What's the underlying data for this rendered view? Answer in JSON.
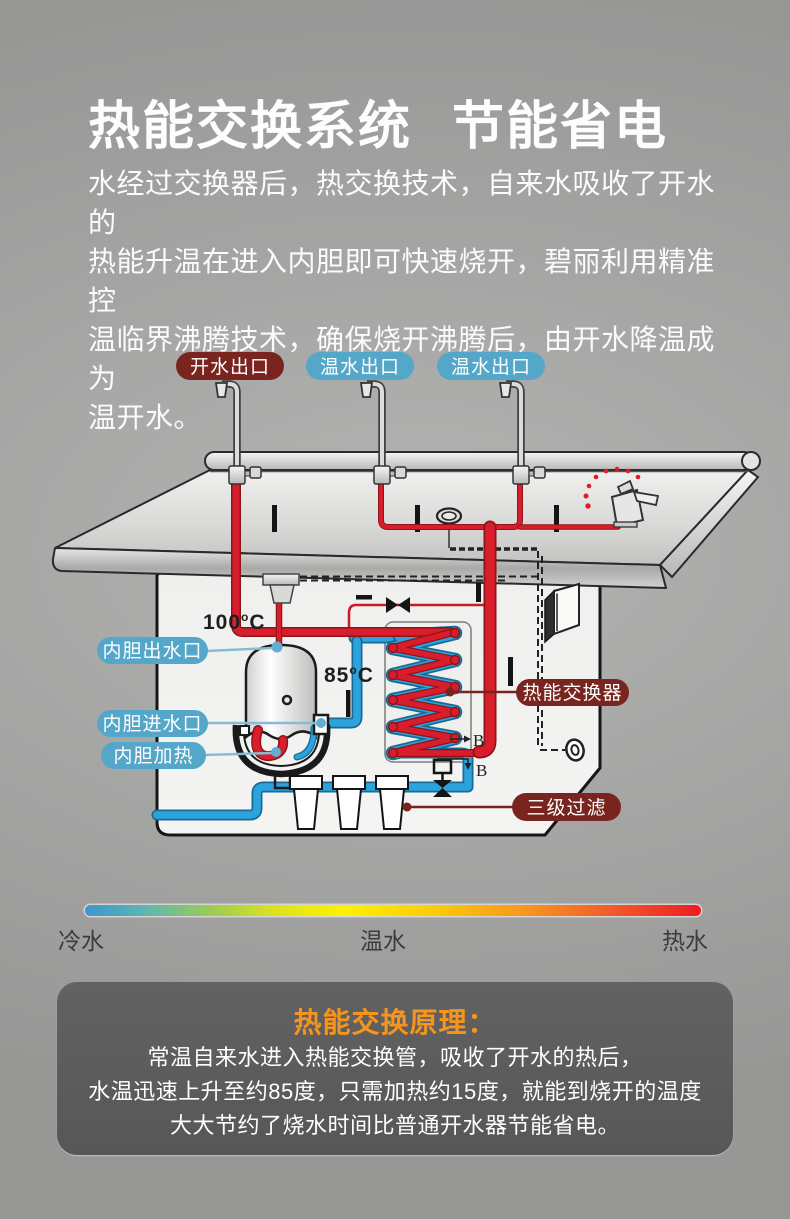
{
  "header": {
    "title_part1": "热能交换系统",
    "title_part2": "节能省电"
  },
  "intro": {
    "lines": [
      "水经过交换器后，热交换技术，自来水吸收了开水的",
      "热能升温在进入内胆即可快速烧开，碧丽利用精准控",
      "温临界沸腾技术，确保烧开沸腾后，由开水降温成为",
      "温开水。"
    ]
  },
  "diagram": {
    "outlet_labels": [
      {
        "text": "开水出口",
        "color": "#7a2420"
      },
      {
        "text": "温水出口",
        "color": "#55a7c9"
      },
      {
        "text": "温水出口",
        "color": "#55a7c9"
      }
    ],
    "part_labels": {
      "tank_outlet": "内胆出水口",
      "tank_inlet": "内胆进水口",
      "tank_heater": "内胆加热",
      "heat_exchanger": "热能交换器",
      "filter": "三级过滤"
    },
    "temp_100": "100",
    "temp_85": "85",
    "deg": "o",
    "unit": "C",
    "b_mark": "B",
    "colors": {
      "hot_pipe": "#d81e2c",
      "cold_pipe": "#2ba3dc",
      "label_blue": "#55a7c9",
      "label_maroon": "#7a2420"
    }
  },
  "scale": {
    "cold": "冷水",
    "warm": "温水",
    "hot": "热水",
    "gradient": [
      "#3d95cf",
      "#9aca57",
      "#fff200",
      "#f7941d",
      "#ed1c24"
    ]
  },
  "principle": {
    "title": "热能交换原理：",
    "title_color": "#f7941d",
    "lines": [
      "常温自来水进入热能交换管，吸收了开水的热后，",
      "水温迅速上升至约85度，只需加热约15度，就能到烧开的温度",
      "大大节约了烧水时间比普通开水器节能省电。"
    ]
  }
}
